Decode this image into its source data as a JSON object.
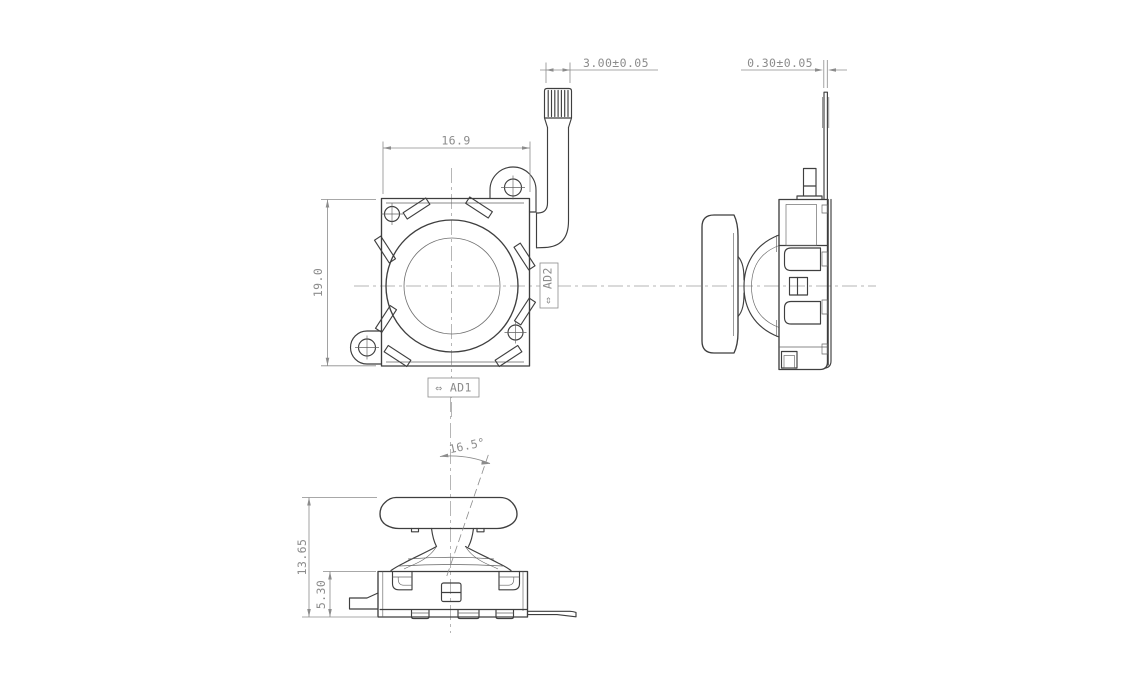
{
  "dims": {
    "fpc_width": "3.00±0.05",
    "fpc_thickness": "0.30±0.05",
    "body_width": "16.9",
    "body_height": "19.0",
    "overall_height": "13.65",
    "base_height": "5.30",
    "tilt_angle": "16.5°"
  },
  "labels": {
    "ad1": "⇔ AD1",
    "ad2": "⇔ AD2"
  },
  "colors": {
    "object_line": "#3f3f3f",
    "dim_line": "#8c8c8c",
    "centerline": "#9e9e9e",
    "background": "#ffffff"
  }
}
